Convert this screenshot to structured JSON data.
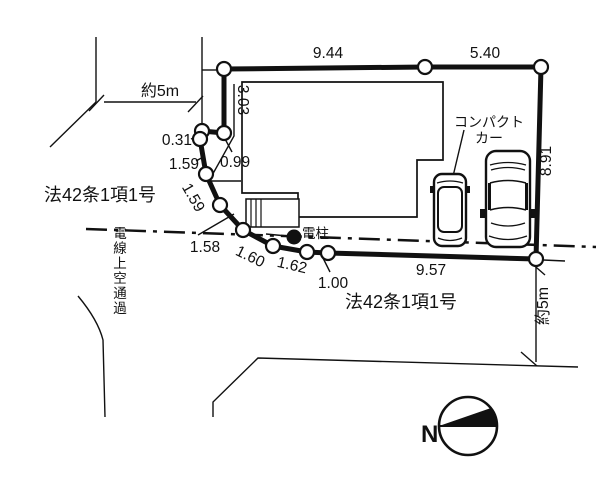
{
  "plan": {
    "dims": {
      "top_left": "9.44",
      "top_right": "5.40",
      "right_side": "8.91",
      "west_vertical": "3.03",
      "seg_0_99": "0.99",
      "seg_0_31": "0.31",
      "seg_1_59_upper": "1.59",
      "seg_1_59_lower": "1.59",
      "seg_1_58": "1.58",
      "seg_1_60": "1.60",
      "seg_1_62": "1.62",
      "seg_1_00": "1.00",
      "seg_9_57": "9.57"
    },
    "roads": {
      "width_west": "約5m",
      "width_south": "約5m",
      "law_west": "法42条1項1号",
      "law_south": "法42条1項1号",
      "power_line_note": "電線上空通過"
    },
    "annotations": {
      "utility_pole": "電柱",
      "compact_car_line1": "コンパクト",
      "compact_car_line2": "カー",
      "compass_north": "N"
    },
    "colors": {
      "line": "#111111",
      "background": "#ffffff"
    }
  }
}
